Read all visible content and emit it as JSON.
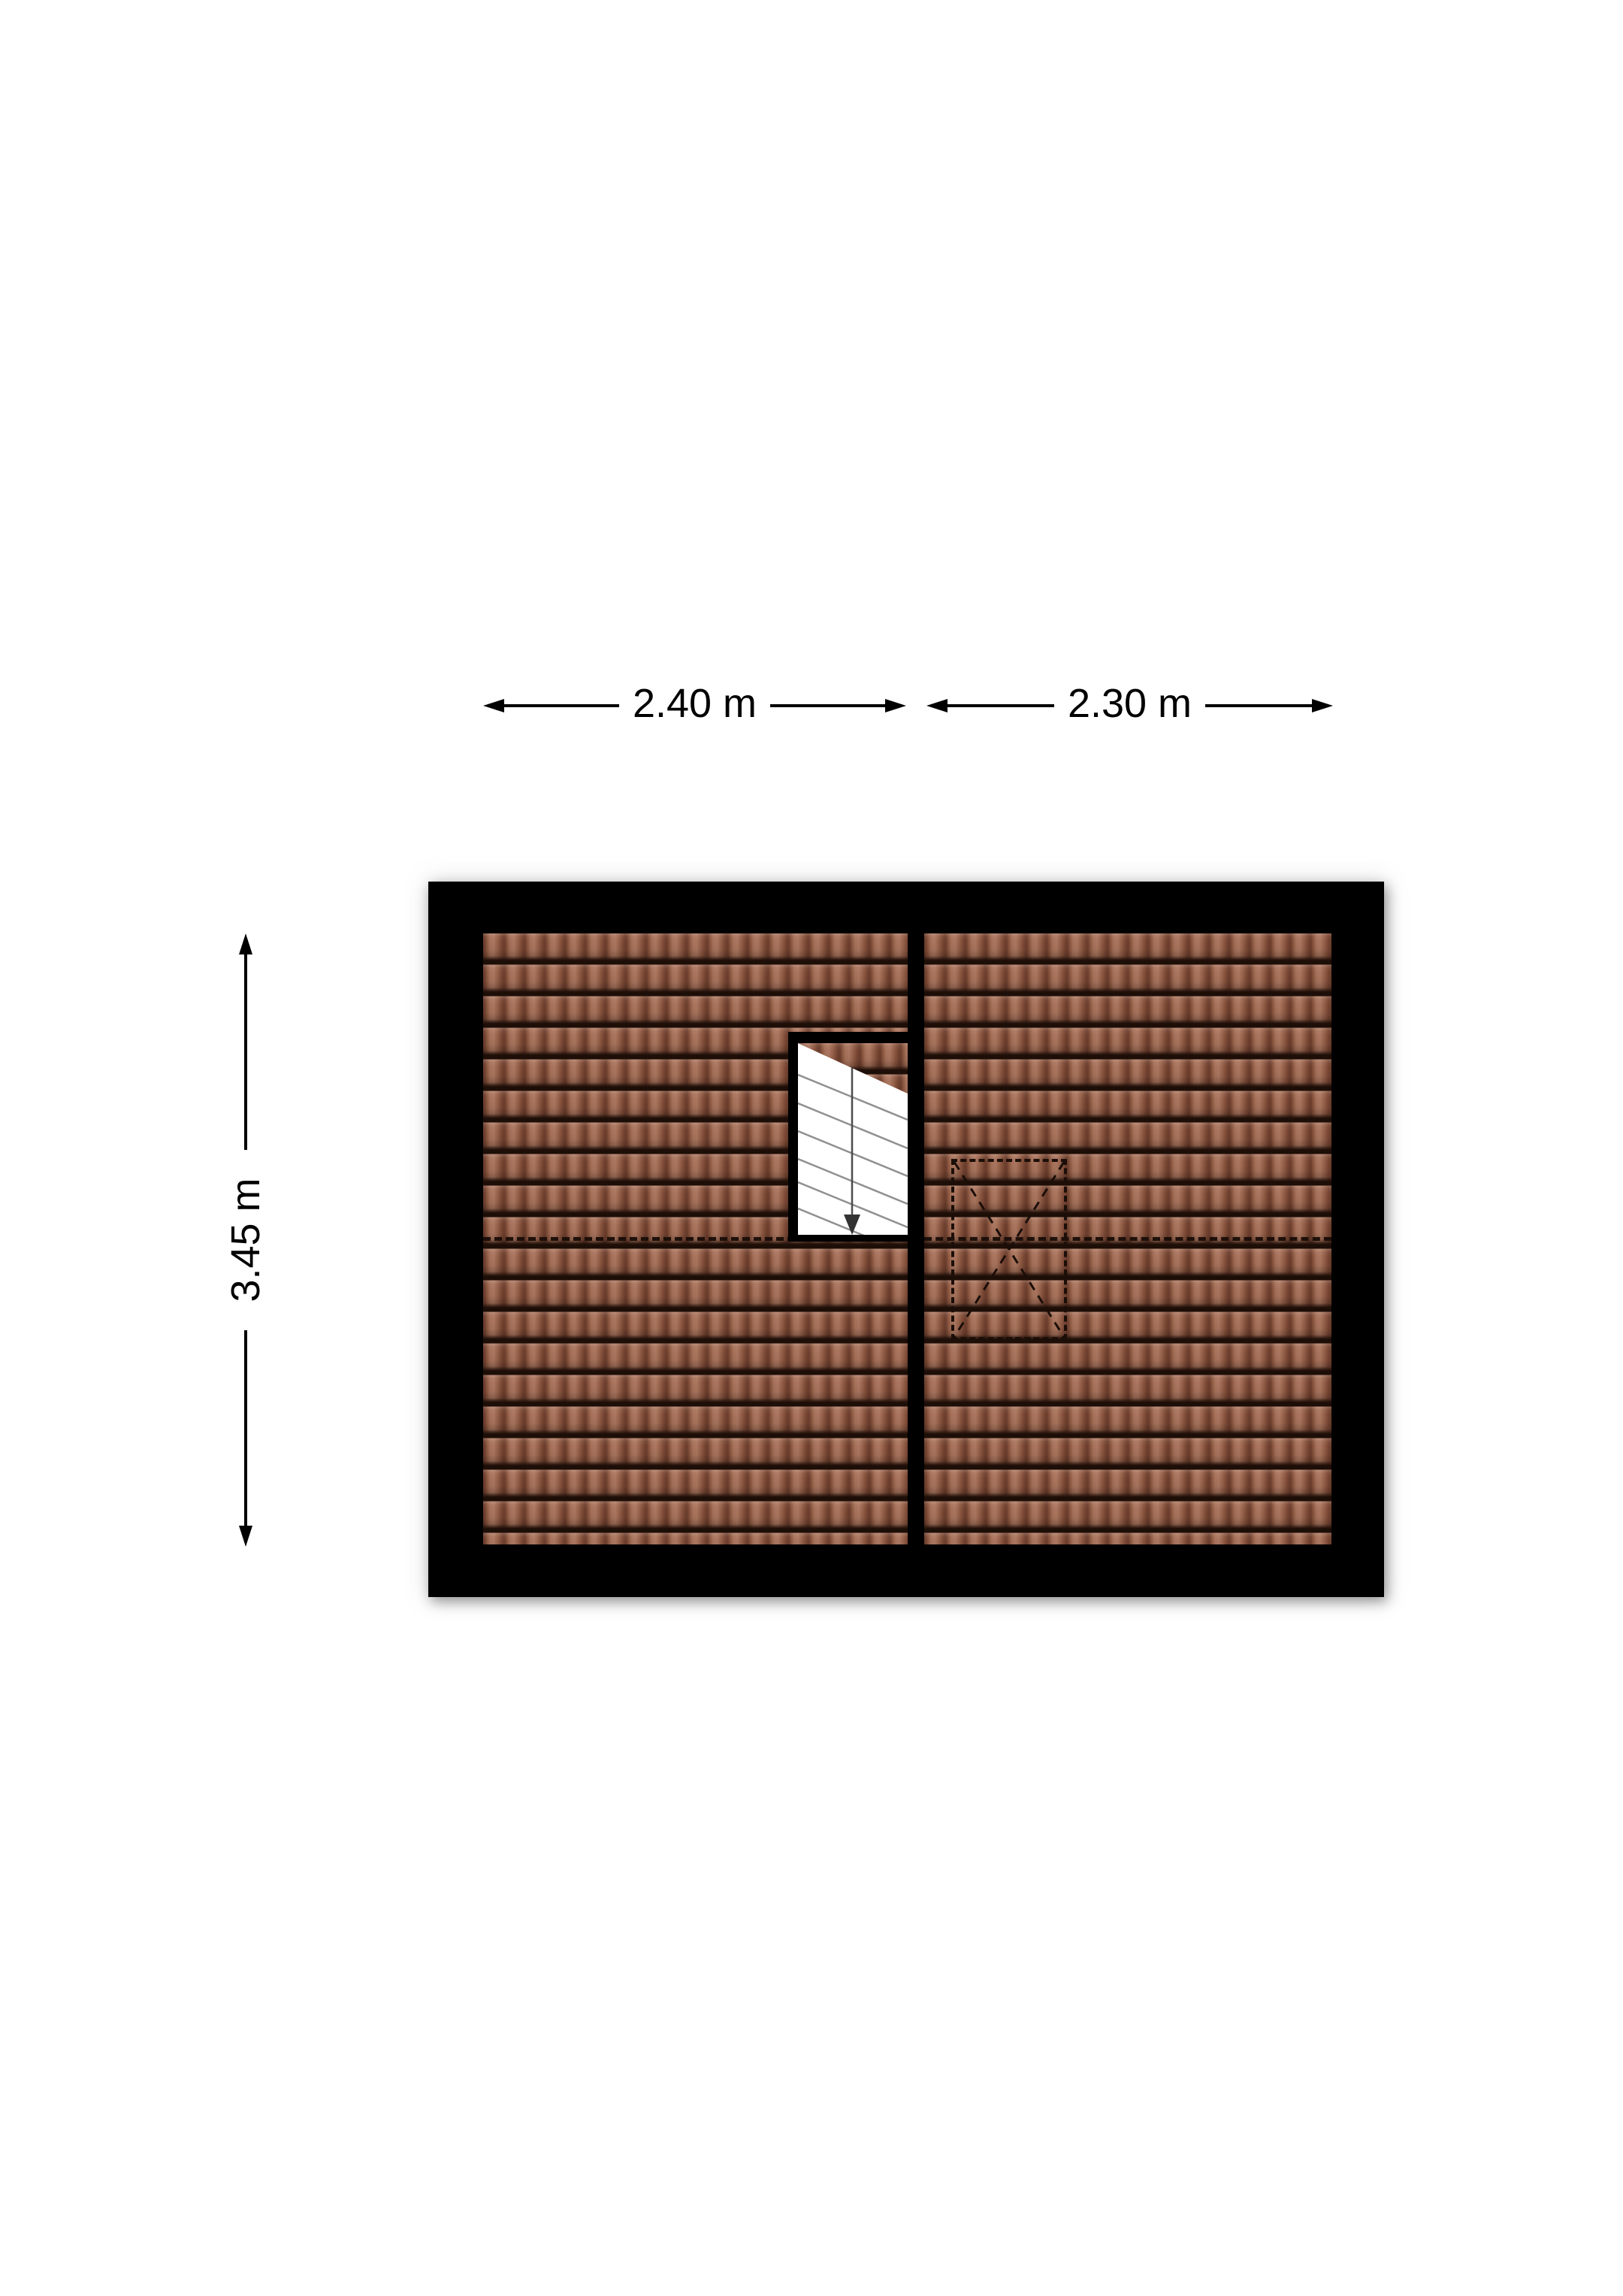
{
  "plan": {
    "kind": "attic-roof-floorplan",
    "dimensions": {
      "top_left_width": "2.40 m",
      "top_right_width": "2.30 m",
      "side_height": "3.45 m"
    },
    "colors": {
      "page_background": "#ffffff",
      "wall": "#000000",
      "roof_tile": "#9a6450",
      "roof_tile_shadow": "#1d0e07",
      "stair_tread": "#909090",
      "walk_line": "#4d4d4d",
      "dashed_outline": "#1b0e08"
    },
    "icons": {
      "walk_direction": "down-arrow"
    },
    "features": {
      "roof_sections": 2,
      "ridge_line_style": "dashed",
      "skylight_outline_style": "dashed"
    }
  }
}
